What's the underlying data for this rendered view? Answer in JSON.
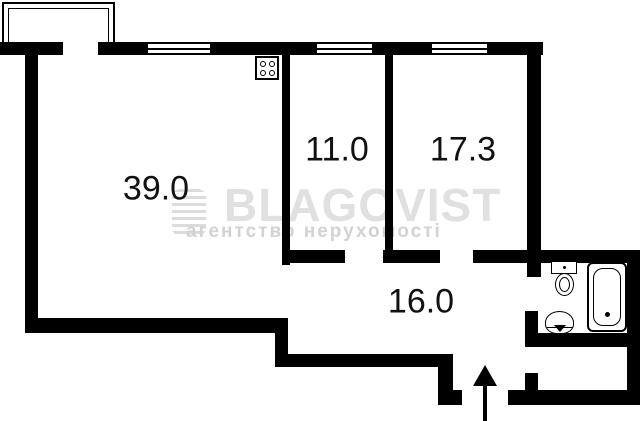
{
  "canvas": {
    "width": 640,
    "height": 421,
    "background": "#ffffff",
    "wall_color": "#000000",
    "label_color": "#111111"
  },
  "watermark": {
    "brand": "BLAGOVIST",
    "tagline": "агентство нерухомості",
    "brand_color": "#e0e0e0",
    "tagline_color": "#d2d2d2",
    "logo": {
      "x": 172,
      "y": 189,
      "w": 34,
      "h": 47
    },
    "brand_pos": {
      "x": 224,
      "y": 182,
      "size": 46
    },
    "tagline_pos": {
      "x": 186,
      "y": 222,
      "size": 19
    }
  },
  "rooms": [
    {
      "id": "room-39",
      "area_label": "39.0",
      "cx": 156,
      "cy": 189
    },
    {
      "id": "room-11",
      "area_label": "11.0",
      "cx": 337,
      "cy": 150
    },
    {
      "id": "room-17",
      "area_label": "17.3",
      "cx": 463,
      "cy": 150
    },
    {
      "id": "hallway-16",
      "area_label": "16.0",
      "cx": 421,
      "cy": 302
    }
  ],
  "walls": [
    {
      "x": 0,
      "y": 42,
      "w": 63,
      "h": 13
    },
    {
      "x": 98,
      "y": 42,
      "w": 50,
      "h": 13
    },
    {
      "x": 210,
      "y": 42,
      "w": 107,
      "h": 13
    },
    {
      "x": 372,
      "y": 42,
      "w": 60,
      "h": 13
    },
    {
      "x": 487,
      "y": 42,
      "w": 56,
      "h": 13
    },
    {
      "x": 25,
      "y": 55,
      "w": 13,
      "h": 278
    },
    {
      "x": 25,
      "y": 318,
      "w": 263,
      "h": 15
    },
    {
      "x": 275,
      "y": 333,
      "w": 13,
      "h": 34
    },
    {
      "x": 283,
      "y": 354,
      "w": 170,
      "h": 13
    },
    {
      "x": 438,
      "y": 354,
      "w": 15,
      "h": 51
    },
    {
      "x": 438,
      "y": 390,
      "w": 24,
      "h": 15
    },
    {
      "x": 508,
      "y": 390,
      "w": 132,
      "h": 15
    },
    {
      "x": 627,
      "y": 250,
      "w": 13,
      "h": 155
    },
    {
      "x": 282,
      "y": 250,
      "w": 63,
      "h": 13
    },
    {
      "x": 383,
      "y": 250,
      "w": 57,
      "h": 13
    },
    {
      "x": 473,
      "y": 250,
      "w": 167,
      "h": 13
    },
    {
      "x": 282,
      "y": 55,
      "w": 8,
      "h": 210
    },
    {
      "x": 385,
      "y": 55,
      "w": 8,
      "h": 195
    },
    {
      "x": 527,
      "y": 42,
      "w": 14,
      "h": 235
    },
    {
      "x": 525,
      "y": 311,
      "w": 13,
      "h": 36
    },
    {
      "x": 525,
      "y": 333,
      "w": 115,
      "h": 14
    },
    {
      "x": 525,
      "y": 373,
      "w": 13,
      "h": 19
    }
  ],
  "windows": [
    {
      "x": 148,
      "y": 42,
      "w": 62,
      "h": 13
    },
    {
      "x": 317,
      "y": 42,
      "w": 55,
      "h": 13
    },
    {
      "x": 432,
      "y": 42,
      "w": 55,
      "h": 13
    }
  ],
  "balcony": {
    "x": 2,
    "y": 2,
    "w": 113,
    "h": 41
  },
  "fixtures": {
    "stove": {
      "x": 255,
      "y": 56,
      "w": 24,
      "h": 24
    },
    "toilet_tank": {
      "x": 551,
      "y": 261,
      "w": 26,
      "h": 13
    },
    "toilet_bowl": {
      "x": 555,
      "y": 273,
      "w": 19,
      "h": 23
    },
    "bathtub": {
      "x": 587,
      "y": 262,
      "w": 40,
      "h": 70
    },
    "sink": {
      "x": 545,
      "y": 311,
      "w": 29,
      "h": 23
    }
  },
  "entrance_arrow": {
    "x": 485,
    "tip_y": 365,
    "head_w": 24,
    "head_h": 21,
    "base_y": 421
  }
}
